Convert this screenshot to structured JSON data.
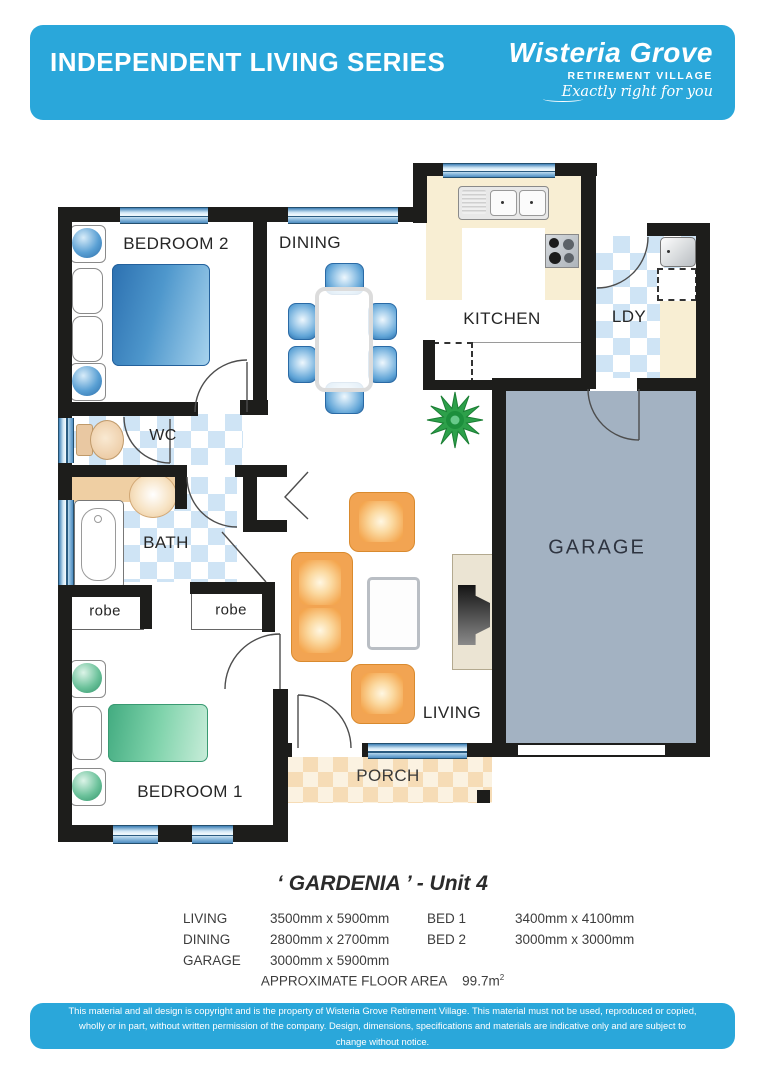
{
  "header": {
    "title": "INDEPENDENT LIVING SERIES",
    "brand": "Wisteria Grove",
    "brand_sub": "RETIREMENT VILLAGE",
    "tagline": "Exactly right for you"
  },
  "rooms": {
    "bedroom2": "BEDROOM 2",
    "dining": "DINING",
    "kitchen": "KITCHEN",
    "laundry": "LDY",
    "wc": "WC",
    "bath": "BATH",
    "robe_left": "robe",
    "robe_right": "robe",
    "bedroom1": "BEDROOM 1",
    "living": "LIVING",
    "porch": "PORCH",
    "garage": "GARAGE"
  },
  "unit": {
    "title": "‘ GARDENIA ’  - Unit 4"
  },
  "dimensions": {
    "rows": [
      [
        "LIVING",
        "3500mm x 5900mm",
        "BED 1",
        "3400mm x 4100mm"
      ],
      [
        "DINING",
        "2800mm x 2700mm",
        "BED 2",
        "3000mm x 3000mm"
      ],
      [
        "GARAGE",
        "3000mm x 5900mm",
        "",
        ""
      ]
    ]
  },
  "floor_area": {
    "label": "APPROXIMATE FLOOR AREA",
    "value": "99.7m",
    "sup": "2"
  },
  "footer": {
    "disclaimer": "This material and all design is copyright and is the property of Wisteria Grove Retirement Village. This material must not be used, reproduced or copied, wholly or in part, without written permission of the company. Design, dimensions, specifications and materials are indicative only and are subject to change without notice."
  },
  "colors": {
    "accent_blue": "#2aa7da",
    "wall_black": "#1d1d1b",
    "garage_fill": "#a3b2c2",
    "tile_blue": "#cfe4f5",
    "tile_orange": "#f6dcb6",
    "bench_cream": "#f8eed3",
    "bed_blue": "#4e97cc",
    "bed_green": "#7fd3ab",
    "sofa_orange": "#f2a452",
    "plant_green": "#2da04a"
  }
}
